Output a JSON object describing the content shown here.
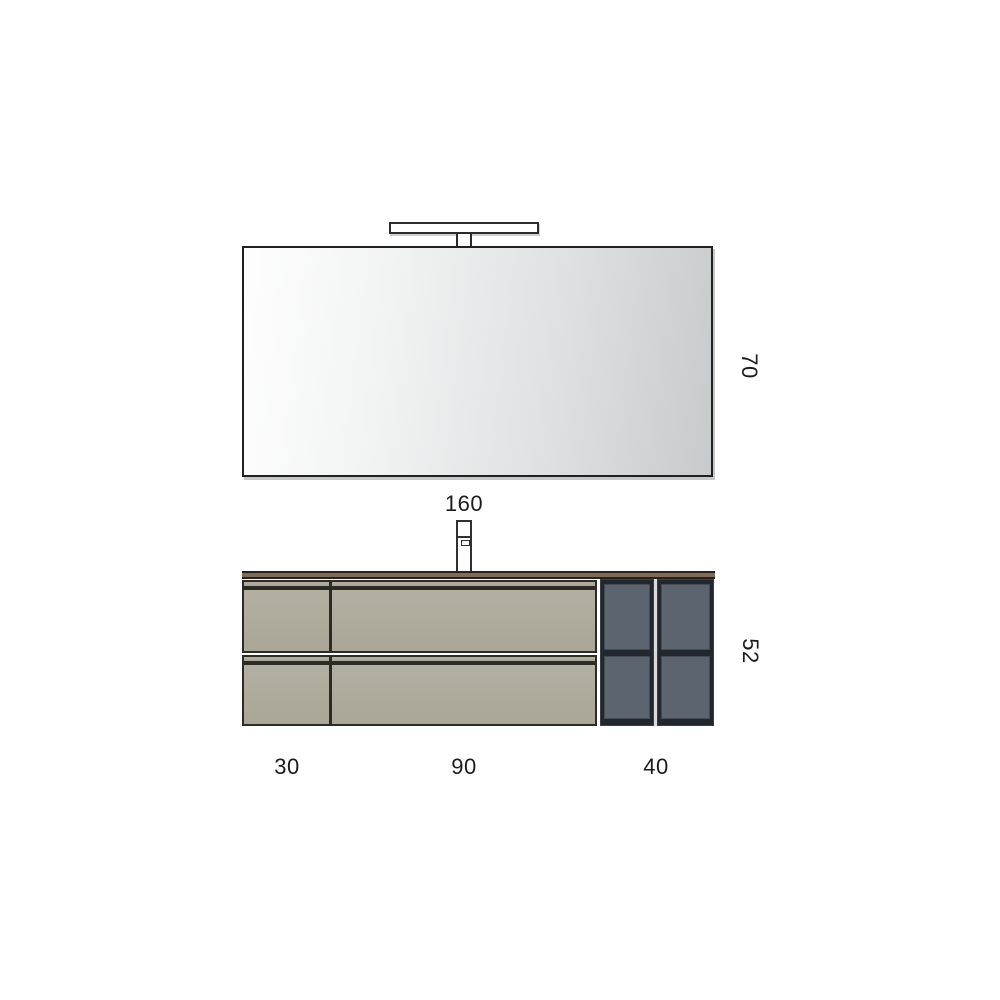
{
  "drawing": {
    "kind": "bathroom-vanity-elevation",
    "dimensions": {
      "mirror_height": "70",
      "total_width": "160",
      "cabinet_height": "52",
      "modules": [
        {
          "name": "left-drawer-module",
          "width_label": "30"
        },
        {
          "name": "center-basin-module",
          "width_label": "90"
        },
        {
          "name": "right-open-shelf-module",
          "width_label": "40"
        }
      ]
    },
    "colors": {
      "background": "#ffffff",
      "outline": "#202020",
      "mirror_gradient_start": "#fefefe",
      "mirror_gradient_end": "#c8cacb",
      "countertop_brown": "#7d6c5a",
      "drawer_front_beige": "#aeaa9d",
      "shelf_frame_dark": "#22272e",
      "shelf_panel_slate": "#5c6470",
      "dimension_text": "#1b1b1b"
    }
  }
}
